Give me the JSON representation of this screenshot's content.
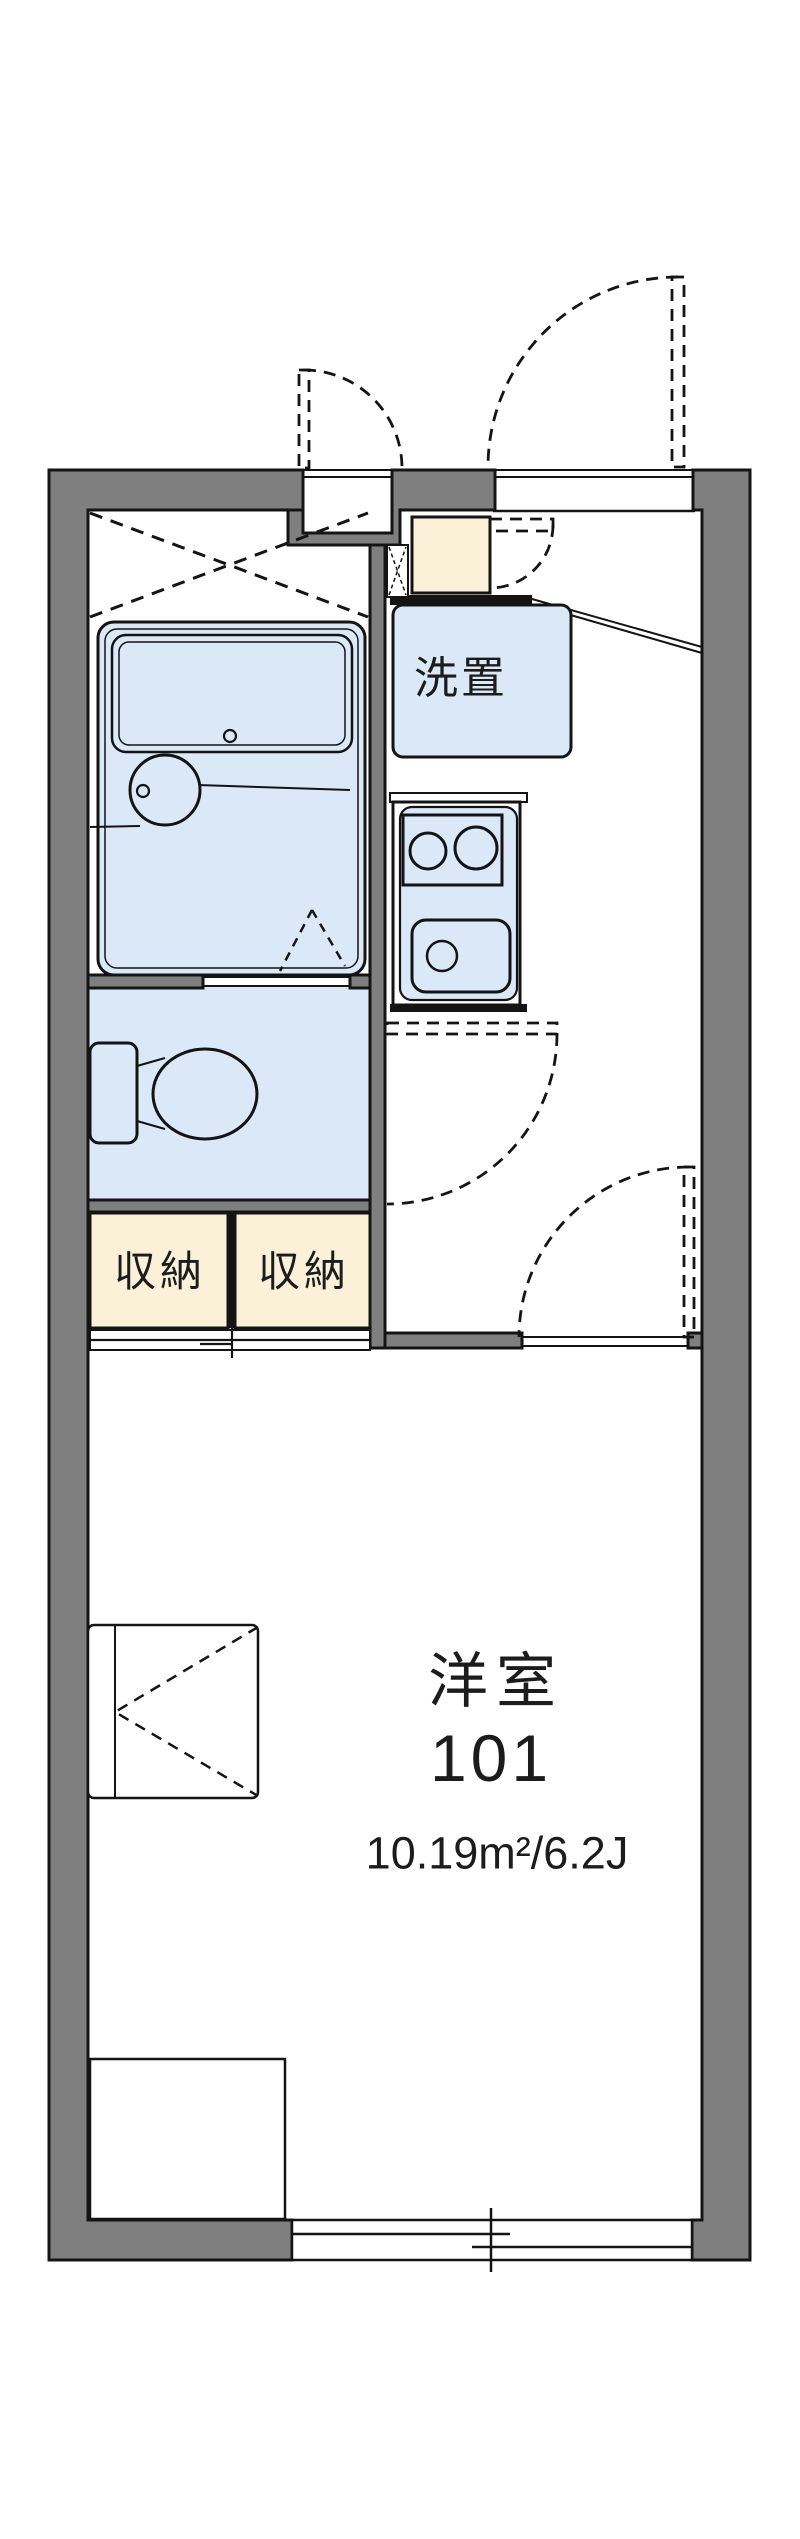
{
  "labels": {
    "washer_space": "洗置",
    "storage_left": "収納",
    "storage_right": "収納",
    "room_name": "洋室",
    "room_number": "101",
    "room_area": "10.19m²/6.2J"
  },
  "colors": {
    "wall_gray": "#7f7f7f",
    "fixture_blue": "#dbe8f7",
    "storage_cream": "#faf1d8",
    "line_black": "#141414",
    "background": "#ffffff"
  }
}
